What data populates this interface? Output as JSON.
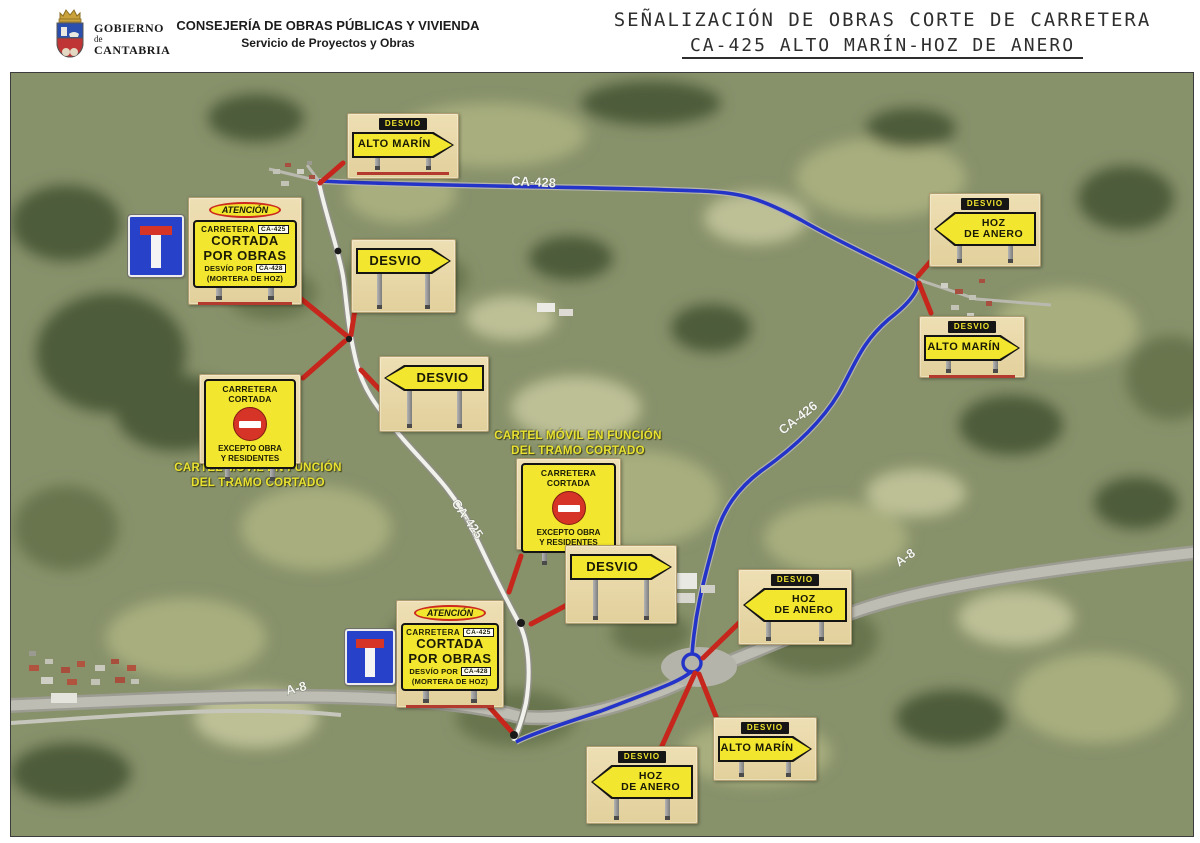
{
  "header": {
    "org": {
      "line1": "GOBIERNO",
      "line2": "de",
      "line3": "CANTABRIA"
    },
    "department": "CONSEJERÍA DE OBRAS PÚBLICAS Y VIVIENDA",
    "service": "Servicio de Proyectos y Obras",
    "title_line1": "SEÑALIZACIÓN DE OBRAS CORTE DE CARRETERA",
    "title_line2": "CA-425 ALTO MARÍN-HOZ DE ANERO"
  },
  "map": {
    "road_labels": {
      "ca428": "CA-428",
      "ca425": "CA-425",
      "ca426": "CA-426",
      "a8_east": "A-8",
      "a8_west": "A-8"
    },
    "captions": {
      "west": "CARTEL MÓVIL EN FUNCIÓN\nDEL TRAMO CORTADO",
      "center": "CARTEL MÓVIL EN FUNCIÓN\nDEL TRAMO CORTADO"
    },
    "signs": {
      "atencion": {
        "badge": "ATENCIÓN",
        "line1_pre": "CARRETERA",
        "line1_box": "CA-425",
        "line2": "CORTADA",
        "line3": "POR OBRAS",
        "line4_pre": "DESVÍO POR",
        "line4_box": "CA-428",
        "line5": "(MORTERA DE HOZ)"
      },
      "cortada": {
        "top": "CARRETERA CORTADA",
        "bottom": "EXCEPTO OBRA\nY RESIDENTES"
      },
      "detour": [
        {
          "tag": "DESVIO",
          "label": "ALTO MARÍN",
          "dir": "right"
        },
        {
          "label": "DESVIO",
          "dir": "right"
        },
        {
          "label": "DESVIO",
          "dir": "left"
        },
        {
          "label": "DESVIO",
          "dir": "right"
        },
        {
          "tag": "DESVIO",
          "label": "HOZ\nDE ANERO",
          "dir": "left"
        },
        {
          "tag": "DESVIO",
          "label": "ALTO MARÍN",
          "dir": "right"
        },
        {
          "tag": "DESVIO",
          "label": "HOZ\nDE ANERO",
          "dir": "left"
        },
        {
          "tag": "DESVIO",
          "label": "ALTO MARÍN",
          "dir": "right"
        },
        {
          "tag": "DESVIO",
          "label": "HOZ\nDE ANERO",
          "dir": "left"
        }
      ]
    },
    "colors": {
      "detour_route": "#2433c8",
      "closed_route": "#f2f2ec",
      "connector_red": "#c6261b",
      "sign_yellow": "#f2e62e",
      "panel_beige": "#e8d7a9",
      "deadend_blue": "#2741c8"
    }
  }
}
